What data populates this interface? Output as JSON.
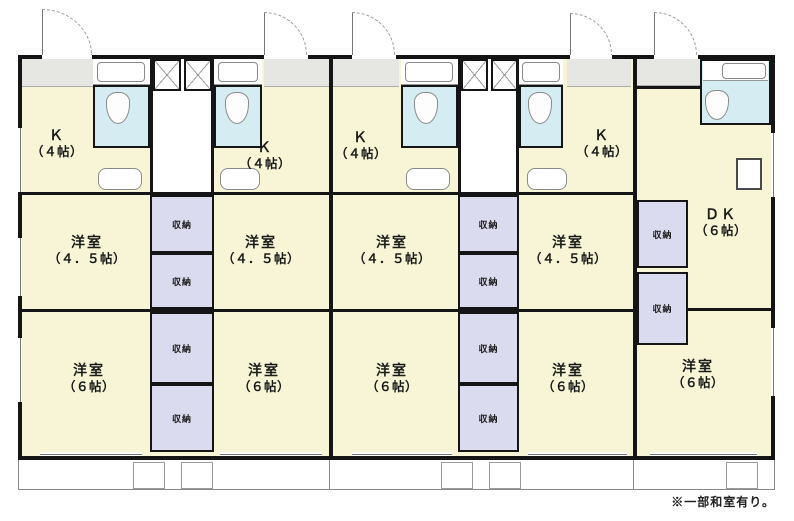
{
  "floorplan": {
    "footnote": "※一部和室有り。",
    "closet_label": "収納",
    "units": [
      {
        "id": "unit-1",
        "rooms": [
          {
            "label": "Ｋ",
            "size": "（４帖）"
          },
          {
            "label": "洋室",
            "size": "（４．５帖）"
          },
          {
            "label": "洋室",
            "size": "（６帖）"
          }
        ]
      },
      {
        "id": "unit-2",
        "rooms": [
          {
            "label": "Ｋ",
            "size": "（４帖）"
          },
          {
            "label": "洋室",
            "size": "（４．５帖）"
          },
          {
            "label": "洋室",
            "size": "（６帖）"
          }
        ]
      },
      {
        "id": "unit-3",
        "rooms": [
          {
            "label": "Ｋ",
            "size": "（４帖）"
          },
          {
            "label": "洋室",
            "size": "（４．５帖）"
          },
          {
            "label": "洋室",
            "size": "（６帖）"
          }
        ]
      },
      {
        "id": "unit-4",
        "rooms": [
          {
            "label": "Ｋ",
            "size": "（４帖）"
          },
          {
            "label": "洋室",
            "size": "（４．５帖）"
          },
          {
            "label": "洋室",
            "size": "（６帖）"
          }
        ]
      },
      {
        "id": "unit-5",
        "rooms": [
          {
            "label": "ＤＫ",
            "size": "（６帖）"
          },
          {
            "label": "洋室",
            "size": "（６帖）"
          }
        ]
      }
    ],
    "colors": {
      "room_fill": "#F7F5D5",
      "bath_fill": "#D5EDF2",
      "closet_fill": "#DBDBF0",
      "genkan_fill": "#E6E6E2",
      "wall": "#151515"
    }
  }
}
